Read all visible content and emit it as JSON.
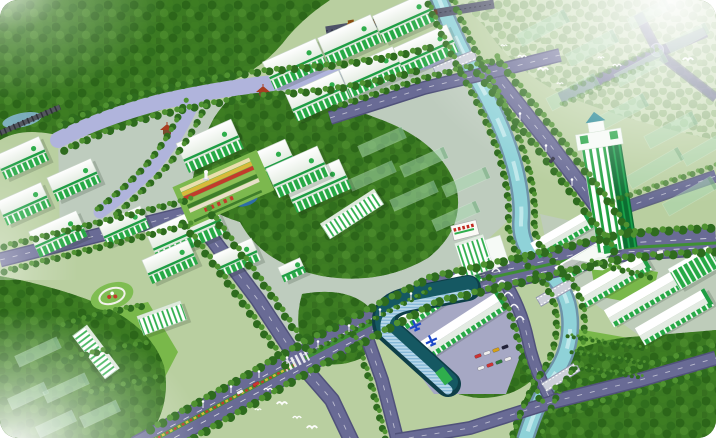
{
  "meta": {
    "title": "Aerial master-plan rendering of a green eco industrial park",
    "description": "3D bird's-eye architectural rendering: forested hills, white and green factory halls, a teal canal with bridges, tree-lined boulevards, a striped high-rise tower, warehouses, a curved glass building, flower gardens, a train on a bridge, flying birds and hazy planned buildings"
  },
  "palette": {
    "base": "#b9cfa0",
    "forest": "#3b7a22",
    "forest_pale": "#c8dcb4",
    "lawn": "#79b84a",
    "paving": "#c6c8e2",
    "plaza": "#a6a8c4",
    "road": "#696b95",
    "road_edge": "#50527a",
    "median_green": "#3f8f34",
    "canal": "#8fd2d8",
    "canal_edge": "#6d93a8",
    "canal_light": "#c8ecef",
    "river": "#b0b4dc",
    "building_white": "#f6faf6",
    "building_green": "#2fae4c",
    "building_trim": "#1f9e44",
    "glass_roof": "#0e3f48",
    "glass_mid": "#155862",
    "tower_green": "#1fa03e",
    "cupola_teal": "#177f8d",
    "future_green": "#a8d8b0",
    "tree_dark": "#2e6b1e",
    "tree_light": "#4f9230",
    "flower_red": "#c23b2c",
    "flower_yellow": "#d9b93a",
    "train_engine": "#b8701c",
    "train_car": "#6e3a1e",
    "bird": "#ffffff",
    "plane_blue": "#1e49c8",
    "statue": "#f4f4f4",
    "pagoda": "#a83c20",
    "pond": "#2e6da8",
    "lake": "#8ab8d8"
  },
  "scene": {
    "ground": {
      "campus": "M58,136 L436,56 L470,92 L520,210 L430,292 L298,360 L190,214 L60,238 Z",
      "warehouse_zone": "M540,214 L648,238 L716,252 L716,346 L640,336 L586,298 L548,252 Z",
      "plaza": "M386,294 L500,274 L530,330 L506,394 L434,394 Q402,352 388,324 Z",
      "pale_forest": "M452,0 L716,0 L716,140 Q636,124 566,96 Q512,70 486,28 Q470,10 452,0 Z",
      "forest": [
        "M0,0 L330,0 Q300,20 282,44 Q260,70 225,84 Q180,100 140,120 Q90,142 52,134 Q20,128 0,140 Z",
        "M246,86 Q320,96 382,120 Q440,142 456,186 Q466,228 428,258 Q380,286 322,276 Q262,264 240,222 Q200,210 192,186 Q196,150 214,118 Q228,96 246,86 Z",
        "M512,438 Q520,394 548,364 Q588,338 646,336 L716,330 L716,438 Z",
        "M0,276 Q64,288 108,308 Q152,330 164,366 Q172,404 148,438 L0,438 Z",
        "M302,294 Q348,286 370,308 Q382,336 362,358 Q330,372 308,356 Q292,330 302,294 Z",
        "M438,342 Q480,332 516,344 Q538,358 532,380 Q512,398 480,398 Q450,396 438,380 Q428,360 438,342 Z"
      ],
      "lawns": [
        "M52,322 L148,302 L178,352 L152,402 L72,410 L44,362 Z",
        "M560,326 L652,342 L646,386 L566,376 Z",
        "M590,260 L658,272 L650,306 L596,296 Z"
      ]
    },
    "water": {
      "river": "M58,140 Q100,118 160,102 Q240,84 310,80 Q380,74 437,58",
      "branch": "M196,96 Q178,140 150,170 Q128,192 100,212",
      "canal": "M437,-6 Q455,40 482,88 Q505,130 515,168 Q523,200 521,222 Q520,248 543,266 Q568,288 570,318 Q572,348 556,372 Q538,398 525,440",
      "lake": [
        22,
        120,
        20,
        7,
        -12
      ],
      "pond": [
        247,
        201,
        11,
        4.5,
        -20
      ]
    },
    "roads": [
      {
        "name": "factory-west-road",
        "d": "M0,260 L95,236 L192,212",
        "w": 12
      },
      {
        "name": "cross-road-north",
        "d": "M192,212 L258,300 L299,362",
        "w": 13
      },
      {
        "name": "cross-road-south",
        "d": "M299,362 L332,400 L352,442",
        "w": 13
      },
      {
        "name": "riverside-road",
        "d": "M486,64 L548,142 L598,208 L626,248",
        "w": 13
      },
      {
        "name": "canal-west-road",
        "d": "M498,272 Q520,302 528,340 Q534,370 552,402",
        "w": 10
      },
      {
        "name": "plaza-west-road",
        "d": "M362,324 L382,380 L398,442",
        "w": 11
      },
      {
        "name": "plaza-south-road",
        "d": "M396,440 L470,428 L552,402",
        "w": 11
      },
      {
        "name": "bottom-right-road",
        "d": "M552,402 L640,380 L716,358",
        "w": 12
      },
      {
        "name": "upper-bridge-road",
        "d": "M330,118 L424,88 L500,70 L560,55",
        "w": 11
      },
      {
        "name": "right-street",
        "d": "M612,212 L716,176",
        "w": 10,
        "o": 0.85
      },
      {
        "name": "tr-street-a",
        "d": "M560,98 L652,55 L706,32",
        "w": 8,
        "o": 0.7
      },
      {
        "name": "tr-street-b",
        "d": "M657,50 L638,14",
        "w": 7,
        "o": 0.65
      },
      {
        "name": "tr-street-c",
        "d": "M662,56 L716,98",
        "w": 7,
        "o": 0.6
      },
      {
        "name": "main-boulevard",
        "d": "M138,450 L299,362 L434,291 Q525,270 625,247 L716,241",
        "w": 26,
        "main": true
      }
    ],
    "boulevard_extras": {
      "median_low": "M146,444 L296,364",
      "median_high": "M305,358 L432,292",
      "median_east": "M436,290 Q520,271 622,248 L716,243",
      "dash_a": "M144,441 L299,357 L434,286 Q523,266 625,243 L716,238",
      "dash_b": "M148,452 L303,368 L436,297 Q525,277 625,252 L716,247"
    },
    "crosswalks": [
      [
        296,
        361,
        -27
      ],
      [
        433,
        290,
        -20
      ]
    ],
    "bridges": [
      [
        455,
        63,
        -22,
        44
      ],
      [
        556,
        292,
        -30,
        40
      ],
      [
        561,
        377,
        -32,
        40
      ]
    ],
    "rail_deck": "M326,31 L494,4",
    "rail_left": "M0,133 L60,107",
    "train": {
      "x": 348,
      "y": 29,
      "r": -9,
      "wagons": 5
    },
    "roundabout": [
      657,
      50
    ],
    "future": [
      [
        543,
        28,
        54,
        14,
        -28
      ],
      [
        592,
        48,
        54,
        14,
        -28
      ],
      [
        641,
        68,
        54,
        14,
        -28
      ],
      [
        573,
        92,
        54,
        14,
        -28
      ],
      [
        622,
        112,
        54,
        14,
        -28
      ],
      [
        671,
        130,
        54,
        14,
        -28
      ],
      [
        688,
        38,
        44,
        12,
        -28
      ],
      [
        649,
        14,
        44,
        12,
        -28
      ],
      [
        655,
        168,
        60,
        14,
        -30
      ],
      [
        690,
        196,
        56,
        14,
        -30
      ],
      [
        703,
        150,
        44,
        12,
        -30
      ],
      [
        382,
        142,
        48,
        12,
        -24
      ],
      [
        424,
        162,
        48,
        12,
        -24
      ],
      [
        466,
        182,
        48,
        12,
        -24
      ],
      [
        372,
        176,
        48,
        12,
        -24
      ],
      [
        414,
        196,
        48,
        12,
        -24
      ],
      [
        456,
        216,
        48,
        12,
        -24
      ],
      [
        38,
        352,
        46,
        12,
        -25
      ],
      [
        66,
        388,
        46,
        12,
        -25
      ],
      [
        28,
        396,
        40,
        12,
        -25
      ],
      [
        56,
        424,
        40,
        12,
        -25
      ],
      [
        100,
        414,
        40,
        12,
        -25
      ]
    ],
    "buildings": [
      [
        "f",
        295,
        64,
        58,
        30,
        -24
      ],
      [
        "f",
        350,
        40,
        58,
        30,
        -24
      ],
      [
        "f",
        405,
        18,
        58,
        30,
        -24
      ],
      [
        "f",
        318,
        96,
        58,
        30,
        -24
      ],
      [
        "f",
        372,
        72,
        58,
        30,
        -24
      ],
      [
        "f",
        426,
        50,
        58,
        30,
        -24
      ],
      [
        "f",
        210,
        146,
        60,
        32,
        -24
      ],
      [
        "f",
        264,
        166,
        60,
        32,
        -24
      ],
      [
        "f",
        318,
        186,
        60,
        32,
        -24
      ],
      [
        "f",
        22,
        158,
        48,
        26,
        -24
      ],
      [
        "f",
        24,
        204,
        48,
        26,
        -24
      ],
      [
        "f",
        74,
        180,
        48,
        26,
        -24
      ],
      [
        "f",
        58,
        234,
        52,
        28,
        -24
      ],
      [
        "f",
        124,
        226,
        46,
        24,
        -24
      ],
      [
        "f",
        186,
        232,
        74,
        34,
        -24
      ],
      [
        "f",
        170,
        262,
        50,
        26,
        -24
      ],
      [
        "f",
        236,
        258,
        44,
        24,
        -24
      ],
      [
        "f",
        298,
        172,
        56,
        32,
        -24
      ],
      [
        "f",
        292,
        270,
        24,
        16,
        -24
      ],
      [
        "w",
        438,
        296,
        92,
        18,
        -33
      ],
      [
        "w",
        464,
        324,
        92,
        18,
        -33
      ],
      [
        "w",
        612,
        280,
        80,
        18,
        -30
      ],
      [
        "w",
        643,
        298,
        80,
        18,
        -30
      ],
      [
        "w",
        674,
        316,
        80,
        18,
        -30
      ],
      [
        "w",
        562,
        234,
        64,
        16,
        -30
      ],
      [
        "w",
        586,
        258,
        64,
        16,
        -30
      ],
      [
        "s",
        352,
        214,
        64,
        18,
        -33
      ],
      [
        "s",
        96,
        352,
        54,
        18,
        53
      ],
      [
        "s",
        162,
        318,
        46,
        20,
        -20
      ],
      [
        "g",
        694,
        268,
        46,
        24,
        -30
      ]
    ],
    "garden": {
      "x": 182,
      "y": 194,
      "r": -24,
      "stripes": [
        "#eadfae",
        "#d9b93a",
        "#c23b2c",
        "#8bbf55",
        "#3f7d2a",
        "#e8e0c8"
      ]
    },
    "park": [
      112,
      296
    ],
    "statue": [
      206,
      176
    ],
    "pagodas": [
      [
        263,
        92
      ],
      [
        167,
        130
      ]
    ],
    "office": {
      "x": 452,
      "y": 236,
      "r": -18
    },
    "tower": {
      "x": 604,
      "y": 252,
      "r": -9
    },
    "curved_building": {
      "casing": "M468,288 L408,300 Q380,306 386,328 L448,384",
      "cap": [
        444,
        376,
        -38
      ]
    },
    "planes": [
      [
        415,
        325,
        -25
      ],
      [
        431,
        340,
        -25
      ]
    ],
    "arcs": [
      [
        490,
        258
      ],
      [
        496,
        270
      ],
      [
        502,
        282
      ],
      [
        508,
        294
      ],
      [
        514,
        306
      ],
      [
        520,
        318
      ]
    ],
    "tree_rows": [
      [
        "M424,-6 Q442,40 469,88 Q492,130 502,168 Q510,200 508,222 Q507,248 530,268 Q554,290 556,318 Q558,348 542,372 Q524,398 511,440",
        7,
        1
      ],
      [
        "M450,-6 Q468,40 495,88 Q518,130 528,168 Q536,200 534,224 Q534,246 556,264 Q582,288 584,318 Q586,348 570,374 Q552,400 539,440",
        7,
        1
      ],
      [
        "M147,432 L295,348 L430,278 Q523,258 622,234 L716,228",
        9,
        1
      ],
      [
        "M160,458 L306,374 L438,302 Q525,282 627,258 L716,252",
        9,
        1
      ],
      [
        "M180,220 L246,308 L287,368",
        8,
        1
      ],
      [
        "M205,206 L270,294 L311,356",
        8,
        1
      ],
      [
        "M496,58 L558,136 L608,202 L636,242",
        8,
        1
      ],
      [
        "M476,72 L538,150 L588,216 L616,254",
        8,
        1
      ],
      [
        "M552,390 L640,368 L716,346",
        8,
        1
      ],
      [
        "M556,414 L642,392 L716,370",
        8,
        1
      ],
      [
        "M350,326 L370,382 L386,442",
        7,
        1
      ],
      [
        "M0,248 L95,224 L190,200",
        7,
        1
      ],
      [
        "M4,272 L98,248 L194,224",
        7,
        1
      ],
      [
        "M58,128 Q100,106 160,90 Q240,72 310,68 Q380,62 430,48",
        8,
        1
      ],
      [
        "M62,152 Q104,130 164,114 Q244,96 314,92 Q370,86 420,70",
        8,
        1
      ],
      [
        "M186,100 Q168,142 140,172 Q118,194 92,214",
        7,
        1
      ],
      [
        "M208,100 Q190,142 162,172 Q140,194 112,218",
        7,
        1
      ],
      [
        "M308,354 L430,290",
        5,
        1
      ],
      [
        "M52,330 Q100,312 146,306 M60,362 Q100,350 150,344 M80,396 Q120,386 158,378",
        7,
        1
      ],
      [
        "M566,336 L648,350 M570,352 L646,364 M574,368 L644,378",
        4,
        1
      ],
      [
        "M560,106 L650,64 M570,90 L656,48",
        6,
        0.5
      ],
      [
        "M488,276 Q510,306 518,342 Q524,372 542,404",
        7,
        1
      ],
      [
        "M588,262 Q620,270 652,278",
        6,
        1
      ],
      [
        "M610,202 L716,166",
        6,
        0.7
      ],
      [
        "M334,108 L426,78 L500,60",
        7,
        1
      ]
    ],
    "lights": [
      [
        203,
        408
      ],
      [
        231,
        393
      ],
      [
        259,
        378
      ],
      [
        287,
        364
      ],
      [
        318,
        348
      ],
      [
        349,
        332
      ],
      [
        380,
        316
      ],
      [
        411,
        300
      ],
      [
        520,
        120
      ],
      [
        546,
        152
      ],
      [
        572,
        186
      ]
    ],
    "cars": [
      [
        478,
        356,
        -20,
        "#cc3333"
      ],
      [
        487,
        353,
        -20,
        "#eeeeee"
      ],
      [
        496,
        350,
        -20,
        "#d4a017"
      ],
      [
        505,
        347,
        -20,
        "#22223a"
      ],
      [
        481,
        368,
        -20,
        "#eeeeee"
      ],
      [
        490,
        365,
        -20,
        "#cc3333"
      ],
      [
        499,
        362,
        -20,
        "#2c7a3a"
      ],
      [
        508,
        359,
        -20,
        "#eeeeee"
      ],
      [
        240,
        392,
        -28,
        "#efefef"
      ],
      [
        256,
        384,
        -28,
        "#cc3333"
      ],
      [
        552,
        160,
        -52,
        "#333347"
      ],
      [
        660,
        252,
        -12,
        "#efefef"
      ]
    ],
    "birds": [
      [
        504,
        46
      ],
      [
        522,
        57
      ],
      [
        543,
        70
      ],
      [
        560,
        84
      ],
      [
        268,
        390
      ],
      [
        282,
        404
      ],
      [
        258,
        410
      ],
      [
        297,
        418
      ],
      [
        312,
        428
      ],
      [
        601,
        58
      ],
      [
        617,
        66
      ],
      [
        688,
        60
      ]
    ]
  }
}
